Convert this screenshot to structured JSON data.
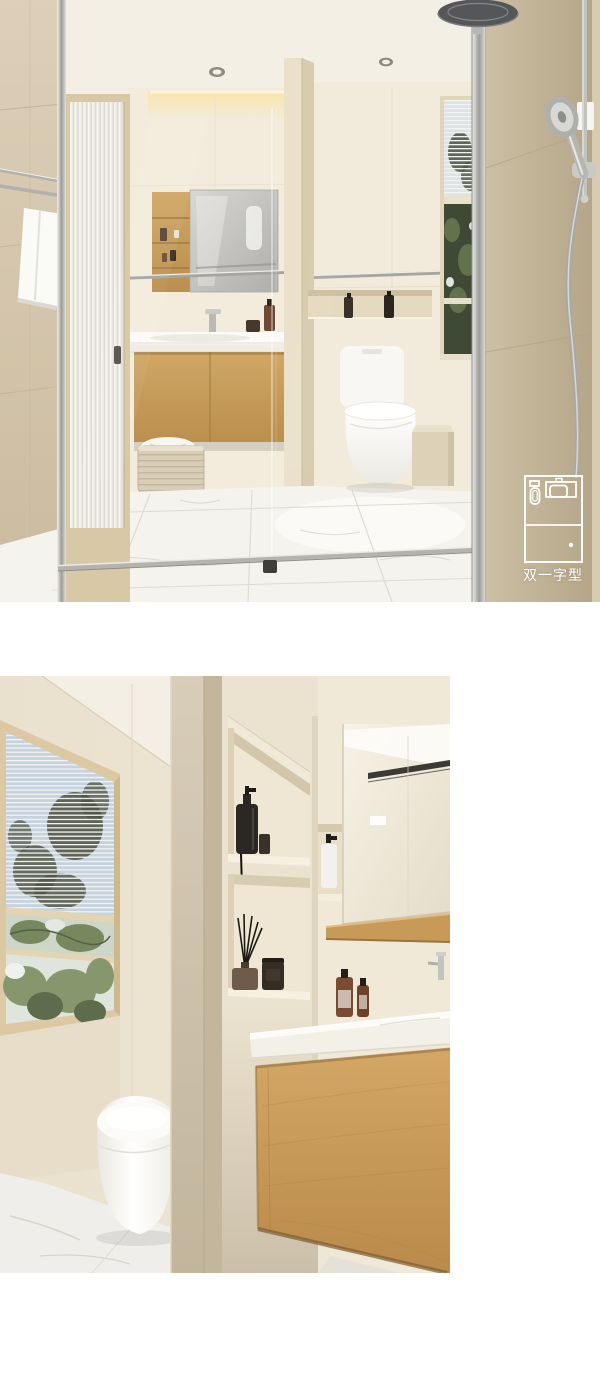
{
  "page": {
    "background": "#ffffff"
  },
  "badge": {
    "label": "双一字型",
    "icon": "floorplan-icon",
    "color": "#ffffff"
  },
  "palette": {
    "white": "#ffffff",
    "cream_wall": "#f2ebdc",
    "beige_wall": "#d7c9b1",
    "dark_beige_wall": "#c2b396",
    "wood": "#c89a58",
    "wood_light": "#d8ab6e",
    "chrome": "#b5b5b1",
    "mirror_gray": "#c6c5c1",
    "marble_floor": "#f5f3ee",
    "foliage_dark": "#49523e",
    "foliage_green": "#7a8a62",
    "sky_blue": "#c6d2dd",
    "bottle_dark": "#2e2922",
    "bottle_amber": "#7b4a33",
    "toilet_white": "#fbfaf7"
  }
}
